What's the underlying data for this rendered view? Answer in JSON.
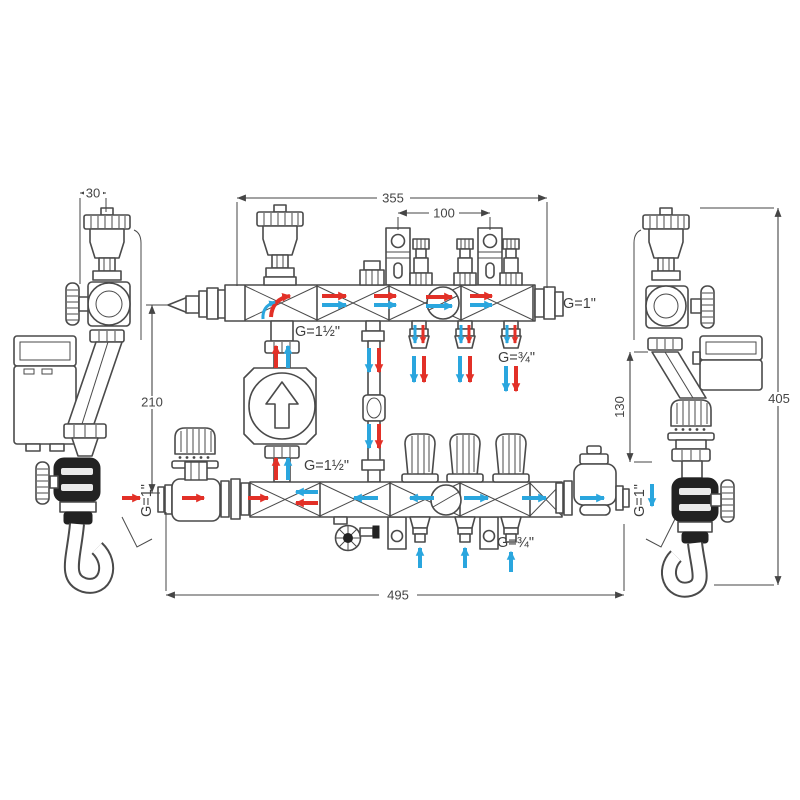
{
  "diagram": {
    "type": "technical-drawing",
    "colors": {
      "line": "#4a4a4a",
      "dim": "#454545",
      "supply": "#e23027",
      "return": "#2aa6de",
      "dark": "#222222",
      "bg": "#ffffff"
    },
    "dimensions": {
      "d30": "30",
      "d355": "355",
      "d100": "100",
      "d210": "210",
      "d130": "130",
      "d405": "405",
      "d495": "495"
    },
    "ports": {
      "top_right": "G=1\"",
      "riser_top": "G=1½\"",
      "loop_supply": "G=¾\"",
      "riser_bottom": "G=1½\"",
      "loop_return": "G=¾\"",
      "inlet_left": "G=1\"",
      "outlet_right": "G=1\""
    }
  }
}
